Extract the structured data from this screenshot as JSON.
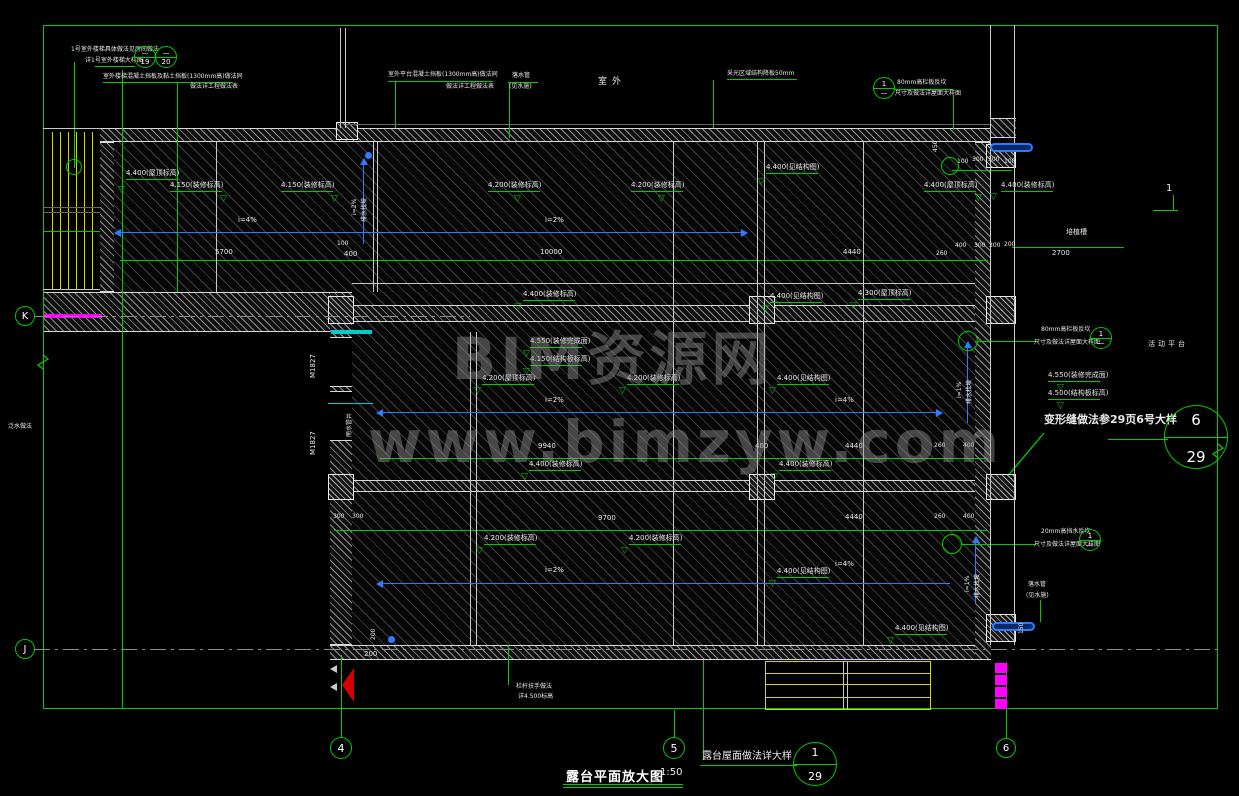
{
  "meta": {
    "drawing_type": "CAD terrace enlarged plan",
    "colors": {
      "line_green": "#00cc00",
      "wall_white": "#d8d8d8",
      "slope_blue": "#2f7bff",
      "stair_yellow": "#d6d600",
      "accent_magenta": "#ff00ff",
      "door_cyan": "#00cccc",
      "flag_red": "#d40000"
    }
  },
  "titles": {
    "main": "露台平面放大图",
    "scale": "1:50",
    "roof_note": "露台屋面做法详大样"
  },
  "watermark": {
    "line1": "BIM资源网",
    "line2": "www.bimzyw.com"
  },
  "texts": [
    {
      "t": "1号室外楼梯具体做法见房间做法",
      "x": 71,
      "y": 47,
      "fs": 6
    },
    {
      "t": "详1号室外楼梯大样图",
      "x": 85,
      "y": 58,
      "fs": 6
    },
    {
      "t": "室外楼梯混凝土挡板及黏土挡板(1300mm高)做法同",
      "x": 103,
      "y": 74,
      "fs": 6
    },
    {
      "t": "做法详工程做法表",
      "x": 190,
      "y": 84,
      "fs": 6
    },
    {
      "t": "室外平台混凝土挡板(1300mm高)做法同",
      "x": 388,
      "y": 72,
      "fs": 6
    },
    {
      "t": "做法详工程做法表",
      "x": 446,
      "y": 84,
      "fs": 6
    },
    {
      "t": "落水管",
      "x": 512,
      "y": 73,
      "fs": 6
    },
    {
      "t": "(见水施)",
      "x": 509,
      "y": 84,
      "fs": 6
    },
    {
      "t": "室外",
      "x": 598,
      "y": 78,
      "fs": 9,
      "ls": 5
    },
    {
      "t": "采光区域结构降板50mm",
      "x": 727,
      "y": 71,
      "fs": 6
    },
    {
      "t": "80mm高栏板反坎",
      "x": 897,
      "y": 80,
      "fs": 6
    },
    {
      "t": "尺寸及做法详屋面大样图",
      "x": 895,
      "y": 91,
      "fs": 6
    },
    {
      "t": "培植槽",
      "x": 1066,
      "y": 229,
      "fs": 7
    },
    {
      "t": "2700",
      "x": 1052,
      "y": 250,
      "fs": 7
    },
    {
      "t": "5700",
      "x": 215,
      "y": 249,
      "fs": 7
    },
    {
      "t": "100",
      "x": 337,
      "y": 241,
      "fs": 6
    },
    {
      "t": "400",
      "x": 344,
      "y": 251,
      "fs": 7
    },
    {
      "t": "10000",
      "x": 540,
      "y": 249,
      "fs": 7
    },
    {
      "t": "4440",
      "x": 843,
      "y": 249,
      "fs": 7
    },
    {
      "t": "260",
      "x": 936,
      "y": 251,
      "fs": 6
    },
    {
      "t": "400",
      "x": 955,
      "y": 243,
      "fs": 6
    },
    {
      "t": "300",
      "x": 974,
      "y": 243,
      "fs": 6
    },
    {
      "t": "300",
      "x": 989,
      "y": 243,
      "fs": 6
    },
    {
      "t": "200",
      "x": 1004,
      "y": 242,
      "fs": 6
    },
    {
      "t": "100",
      "x": 957,
      "y": 159,
      "fs": 6
    },
    {
      "t": "300",
      "x": 972,
      "y": 157,
      "fs": 6
    },
    {
      "t": "300",
      "x": 988,
      "y": 157,
      "fs": 6
    },
    {
      "t": "100",
      "x": 1004,
      "y": 159,
      "fs": 6
    },
    {
      "t": "i=4%",
      "x": 238,
      "y": 217,
      "fs": 7
    },
    {
      "t": "i=2%",
      "x": 545,
      "y": 217,
      "fs": 7
    },
    {
      "t": "i=2%",
      "x": 545,
      "y": 397,
      "fs": 7
    },
    {
      "t": "i=4%",
      "x": 835,
      "y": 397,
      "fs": 7
    },
    {
      "t": "i=2%",
      "x": 545,
      "y": 567,
      "fs": 7
    },
    {
      "t": "i=4%",
      "x": 835,
      "y": 561,
      "fs": 7
    },
    {
      "t": "9940",
      "x": 538,
      "y": 443,
      "fs": 7
    },
    {
      "t": "400",
      "x": 755,
      "y": 443,
      "fs": 7
    },
    {
      "t": "4440",
      "x": 845,
      "y": 443,
      "fs": 7
    },
    {
      "t": "260",
      "x": 934,
      "y": 443,
      "fs": 6
    },
    {
      "t": "400",
      "x": 963,
      "y": 443,
      "fs": 6
    },
    {
      "t": "300",
      "x": 333,
      "y": 514,
      "fs": 6
    },
    {
      "t": "300",
      "x": 352,
      "y": 514,
      "fs": 6
    },
    {
      "t": "9700",
      "x": 598,
      "y": 515,
      "fs": 7
    },
    {
      "t": "4440",
      "x": 845,
      "y": 514,
      "fs": 7
    },
    {
      "t": "260",
      "x": 934,
      "y": 514,
      "fs": 6
    },
    {
      "t": "400",
      "x": 963,
      "y": 514,
      "fs": 6
    },
    {
      "t": "200",
      "x": 364,
      "y": 651,
      "fs": 7
    },
    {
      "t": "栏杆扶手做法",
      "x": 516,
      "y": 684,
      "fs": 6
    },
    {
      "t": "详4.500标高",
      "x": 518,
      "y": 694,
      "fs": 6
    },
    {
      "t": "80mm高栏板反坎",
      "x": 1041,
      "y": 327,
      "fs": 6
    },
    {
      "t": "尺寸及做法详屋面大样图",
      "x": 1034,
      "y": 340,
      "fs": 6
    },
    {
      "t": "活动平台",
      "x": 1148,
      "y": 341,
      "fs": 7,
      "ls": 3
    },
    {
      "t": "变形缝做法参29页6号大样",
      "x": 1044,
      "y": 414,
      "fs": 11,
      "b": 1
    },
    {
      "t": "20mm高挡水反坎",
      "x": 1041,
      "y": 529,
      "fs": 6
    },
    {
      "t": "尺寸及做法详屋面大样图",
      "x": 1034,
      "y": 542,
      "fs": 6
    },
    {
      "t": "落水管",
      "x": 1028,
      "y": 582,
      "fs": 6
    },
    {
      "t": "(见水施)",
      "x": 1026,
      "y": 593,
      "fs": 6
    },
    {
      "t": "1",
      "x": 1166,
      "y": 184,
      "fs": 10
    },
    {
      "t": "泛水做法",
      "x": 8,
      "y": 424,
      "fs": 6
    },
    {
      "t": "M1827",
      "x": 310,
      "y": 378,
      "fs": 7,
      "r": 1
    },
    {
      "t": "M1827",
      "x": 310,
      "y": 455,
      "fs": 7,
      "r": 1
    },
    {
      "t": "雨水管井",
      "x": 347,
      "y": 437,
      "fs": 6,
      "r": 1
    },
    {
      "t": "i=2%",
      "x": 352,
      "y": 215,
      "fs": 6,
      "r": 1
    },
    {
      "t": "排水找坡",
      "x": 362,
      "y": 222,
      "fs": 6,
      "r": 1
    },
    {
      "t": "i=1%",
      "x": 957,
      "y": 398,
      "fs": 6,
      "r": 1
    },
    {
      "t": "排水找坡",
      "x": 967,
      "y": 404,
      "fs": 6,
      "r": 1
    },
    {
      "t": "i=1%",
      "x": 965,
      "y": 592,
      "fs": 6,
      "r": 1
    },
    {
      "t": "排水找坡",
      "x": 975,
      "y": 598,
      "fs": 6,
      "r": 1
    },
    {
      "t": "450",
      "x": 933,
      "y": 152,
      "fs": 6,
      "r": 1
    },
    {
      "t": "200",
      "x": 371,
      "y": 640,
      "fs": 6,
      "r": 1
    },
    {
      "t": "150",
      "x": 1019,
      "y": 634,
      "fs": 6,
      "r": 1
    }
  ],
  "elevations": [
    {
      "t": "4.400(屋顶标高)",
      "x": 126,
      "y": 170,
      "tx": 118,
      "ty": 186
    },
    {
      "t": "4.150(装修标高)",
      "x": 170,
      "y": 182,
      "tx": 220,
      "ty": 195
    },
    {
      "t": "4.150(装修标高)",
      "x": 281,
      "y": 182,
      "tx": 331,
      "ty": 195
    },
    {
      "t": "4.200(装修标高)",
      "x": 488,
      "y": 182,
      "tx": 514,
      "ty": 195
    },
    {
      "t": "4.200(装修标高)",
      "x": 631,
      "y": 182,
      "tx": 658,
      "ty": 195
    },
    {
      "t": "4.400(见结构图)",
      "x": 766,
      "y": 164,
      "tx": 758,
      "ty": 178
    },
    {
      "t": "4.400(屋顶标高)",
      "x": 924,
      "y": 182,
      "tx": 975,
      "ty": 194
    },
    {
      "t": "4.400(装修标高)",
      "x": 1001,
      "y": 182,
      "tx": 990,
      "ty": 193
    },
    {
      "t": "4.400(装修标高)",
      "x": 523,
      "y": 291,
      "tx": 515,
      "ty": 303
    },
    {
      "t": "4.400(见结构图)",
      "x": 770,
      "y": 293,
      "tx": 762,
      "ty": 305
    },
    {
      "t": "4.300(屋顶标高)",
      "x": 858,
      "y": 290,
      "tx": 850,
      "ty": 302
    },
    {
      "t": "4.550(装修完成面)",
      "x": 530,
      "y": 338,
      "tx": 523,
      "ty": 350
    },
    {
      "t": "4.150(结构板标高)",
      "x": 530,
      "y": 356,
      "tx": 523,
      "ty": 368
    },
    {
      "t": "4.200(屋顶标高)",
      "x": 482,
      "y": 375,
      "tx": 474,
      "ty": 387
    },
    {
      "t": "4.200(装修标高)",
      "x": 627,
      "y": 375,
      "tx": 619,
      "ty": 387
    },
    {
      "t": "4.400(见结构图)",
      "x": 777,
      "y": 375,
      "tx": 769,
      "ty": 387
    },
    {
      "t": "4.400(装修标高)",
      "x": 529,
      "y": 461,
      "tx": 521,
      "ty": 473
    },
    {
      "t": "4.400(装修标高)",
      "x": 779,
      "y": 461,
      "tx": 771,
      "ty": 473
    },
    {
      "t": "4.200(装修标高)",
      "x": 484,
      "y": 535,
      "tx": 476,
      "ty": 547
    },
    {
      "t": "4.200(装修标高)",
      "x": 629,
      "y": 535,
      "tx": 621,
      "ty": 547
    },
    {
      "t": "4.400(见结构图)",
      "x": 777,
      "y": 568,
      "tx": 769,
      "ty": 580
    },
    {
      "t": "4.400(见结构图)",
      "x": 895,
      "y": 625,
      "tx": 887,
      "ty": 637
    },
    {
      "t": "4.550(装修完成面)",
      "x": 1048,
      "y": 372,
      "tx": 1057,
      "ty": 384
    },
    {
      "t": "4.500(结构板标高)",
      "x": 1048,
      "y": 390,
      "tx": 1057,
      "ty": 402
    }
  ],
  "detail_bubbles": [
    {
      "x": 145,
      "y": 57,
      "r": 11,
      "top": "—",
      "bot": "19"
    },
    {
      "x": 166,
      "y": 57,
      "r": 11,
      "top": "—",
      "bot": "20"
    },
    {
      "x": 884,
      "y": 88,
      "r": 11,
      "top": "1",
      "bot": "—"
    },
    {
      "x": 1101,
      "y": 338,
      "r": 11,
      "top": "1",
      "bot": "—"
    },
    {
      "x": 1090,
      "y": 540,
      "r": 11,
      "top": "1",
      "bot": "—"
    },
    {
      "x": 1196,
      "y": 437,
      "r": 32,
      "top": "6",
      "bot": "29"
    },
    {
      "x": 815,
      "y": 764,
      "r": 22,
      "top": "1",
      "bot": "29"
    }
  ],
  "grid_bubbles": [
    {
      "t": "K",
      "x": 25,
      "y": 316,
      "r": 10
    },
    {
      "t": "J",
      "x": 25,
      "y": 649,
      "r": 10
    },
    {
      "t": "4",
      "x": 341,
      "y": 748,
      "r": 11
    },
    {
      "t": "5",
      "x": 674,
      "y": 748,
      "r": 11
    },
    {
      "t": "6",
      "x": 1006,
      "y": 748,
      "r": 10
    }
  ],
  "head_circles": [
    {
      "x": 74,
      "y": 167,
      "r": 8
    },
    {
      "x": 950,
      "y": 166,
      "r": 9
    },
    {
      "x": 968,
      "y": 341,
      "r": 10
    },
    {
      "x": 952,
      "y": 544,
      "r": 10
    }
  ],
  "hatches": [
    {
      "x": 100,
      "y": 142,
      "w": 875,
      "h": 150
    },
    {
      "x": 352,
      "y": 292,
      "w": 623,
      "h": 353
    }
  ],
  "walls": [
    {
      "x": 100,
      "y": 128,
      "w": 890,
      "h": 14
    },
    {
      "x": 100,
      "y": 142,
      "w": 14,
      "h": 150
    },
    {
      "x": 43,
      "y": 292,
      "w": 309,
      "h": 40
    },
    {
      "x": 352,
      "y": 305,
      "w": 623,
      "h": 17
    },
    {
      "x": 330,
      "y": 292,
      "w": 22,
      "h": 46
    },
    {
      "x": 330,
      "y": 386,
      "w": 22,
      "h": 6
    },
    {
      "x": 330,
      "y": 440,
      "w": 22,
      "h": 205
    },
    {
      "x": 330,
      "y": 645,
      "w": 660,
      "h": 15
    },
    {
      "x": 975,
      "y": 142,
      "w": 16,
      "h": 518
    },
    {
      "x": 352,
      "y": 480,
      "w": 623,
      "h": 12
    },
    {
      "x": 990,
      "y": 118,
      "w": 26,
      "h": 20
    }
  ],
  "cols": [
    {
      "x": 328,
      "y": 296,
      "w": 26,
      "h": 28
    },
    {
      "x": 749,
      "y": 296,
      "w": 26,
      "h": 28
    },
    {
      "x": 749,
      "y": 474,
      "w": 26,
      "h": 26
    },
    {
      "x": 328,
      "y": 474,
      "w": 26,
      "h": 26
    },
    {
      "x": 986,
      "y": 144,
      "w": 30,
      "h": 24
    },
    {
      "x": 986,
      "y": 296,
      "w": 30,
      "h": 28
    },
    {
      "x": 986,
      "y": 474,
      "w": 30,
      "h": 26
    },
    {
      "x": 986,
      "y": 614,
      "w": 30,
      "h": 28
    },
    {
      "x": 336,
      "y": 122,
      "w": 22,
      "h": 18
    }
  ],
  "lines": [
    [
      "g",
      43,
      25,
      1175,
      1
    ],
    [
      "g",
      43,
      25,
      1,
      684
    ],
    [
      "g",
      1217,
      25,
      1,
      684
    ],
    [
      "g",
      43,
      708,
      1175,
      1
    ],
    [
      "g",
      74,
      62,
      1,
      106
    ],
    [
      "g",
      122,
      70,
      1,
      638
    ],
    [
      "g",
      177,
      83,
      1,
      209
    ],
    [
      "g",
      395,
      81,
      1,
      47
    ],
    [
      "g",
      509,
      82,
      1,
      56
    ],
    [
      "g",
      713,
      80,
      1,
      48
    ],
    [
      "g",
      953,
      95,
      1,
      35
    ],
    [
      "g",
      341,
      655,
      1,
      83
    ],
    [
      "g",
      674,
      710,
      1,
      28
    ],
    [
      "g",
      1006,
      662,
      1,
      77
    ],
    [
      "g",
      703,
      660,
      1,
      100
    ],
    [
      "g",
      508,
      645,
      1,
      40
    ],
    [
      "g",
      1040,
      600,
      1,
      22
    ],
    [
      "g",
      95,
      66,
      40,
      1
    ],
    [
      "g",
      103,
      82,
      130,
      1
    ],
    [
      "g",
      388,
      81,
      105,
      1
    ],
    [
      "g",
      508,
      82,
      30,
      1
    ],
    [
      "g",
      727,
      79,
      70,
      1
    ],
    [
      "g",
      895,
      89,
      58,
      1
    ],
    [
      "g",
      978,
      341,
      58,
      1
    ],
    [
      "g",
      962,
      544,
      74,
      1
    ],
    [
      "g",
      1108,
      439,
      60,
      1
    ],
    [
      "g",
      1173,
      195,
      1,
      16
    ],
    [
      "g",
      1153,
      210,
      25,
      1
    ],
    [
      "g",
      563,
      784,
      120,
      1
    ],
    [
      "g",
      563,
      787,
      120,
      1
    ],
    [
      "g",
      700,
      765,
      97,
      1
    ],
    [
      "g",
      120,
      260,
      868,
      1
    ],
    [
      "g",
      1012,
      247,
      112,
      1
    ],
    [
      "g",
      380,
      458,
      608,
      1
    ],
    [
      "g",
      334,
      530,
      654,
      1
    ],
    [
      "g",
      43,
      231,
      57,
      1
    ],
    [
      "g",
      952,
      170,
      60,
      1
    ],
    [
      "w",
      990,
      25,
      1,
      620
    ],
    [
      "w",
      1014,
      25,
      1,
      620
    ],
    [
      "gr",
      345,
      124,
      645,
      1
    ],
    [
      "w",
      352,
      283,
      623,
      1
    ],
    [
      "w",
      216,
      142,
      1,
      150
    ],
    [
      "w",
      373,
      142,
      1,
      150
    ],
    [
      "w",
      377,
      142,
      1,
      150
    ],
    [
      "w",
      673,
      142,
      1,
      503
    ],
    [
      "w",
      757,
      142,
      1,
      503
    ],
    [
      "w",
      764,
      142,
      1,
      503
    ],
    [
      "w",
      863,
      142,
      1,
      503
    ],
    [
      "w",
      470,
      332,
      1,
      313
    ],
    [
      "w",
      476,
      332,
      1,
      313
    ],
    [
      "w",
      43,
      128,
      57,
      1
    ],
    [
      "w",
      43,
      289,
      57,
      1
    ],
    [
      "gr",
      43,
      207,
      57,
      1
    ],
    [
      "gr",
      43,
      212,
      57,
      1
    ],
    [
      "w",
      340,
      28,
      1,
      100
    ],
    [
      "w",
      345,
      28,
      1,
      100
    ],
    [
      "y",
      765,
      661,
      166,
      1
    ],
    [
      "y",
      765,
      673,
      166,
      1
    ],
    [
      "y",
      765,
      684,
      166,
      1
    ],
    [
      "y",
      765,
      697,
      166,
      1
    ],
    [
      "y",
      765,
      709,
      166,
      1
    ],
    [
      "y",
      765,
      661,
      1,
      49
    ],
    [
      "y",
      930,
      661,
      1,
      49
    ],
    [
      "w",
      843,
      661,
      1,
      49
    ],
    [
      "w",
      847,
      661,
      1,
      49
    ],
    [
      "b",
      120,
      232,
      625,
      1
    ],
    [
      "b",
      380,
      412,
      560,
      1
    ],
    [
      "b",
      380,
      583,
      570,
      1
    ],
    [
      "b",
      363,
      162,
      1,
      82
    ],
    [
      "b",
      967,
      345,
      1,
      78
    ],
    [
      "b",
      975,
      540,
      1,
      64
    ],
    [
      "m",
      44,
      314,
      58,
      4
    ],
    [
      "c",
      331,
      330,
      41,
      4
    ],
    [
      "c",
      328,
      403,
      45,
      1
    ]
  ],
  "dashes": [
    {
      "x": 34,
      "y": 316,
      "w": 436
    },
    {
      "x": 34,
      "y": 649,
      "w": 1183
    }
  ],
  "tris": [
    {
      "x": 114,
      "y": 229,
      "d": "l",
      "c": "b"
    },
    {
      "x": 741,
      "y": 229,
      "d": "r",
      "c": "b"
    },
    {
      "x": 376,
      "y": 409,
      "d": "l",
      "c": "b"
    },
    {
      "x": 936,
      "y": 409,
      "d": "r",
      "c": "b"
    },
    {
      "x": 376,
      "y": 580,
      "d": "l",
      "c": "b"
    },
    {
      "x": 360,
      "y": 158,
      "d": "u",
      "c": "b"
    },
    {
      "x": 964,
      "y": 341,
      "d": "u",
      "c": "b"
    },
    {
      "x": 972,
      "y": 536,
      "d": "u",
      "c": "b"
    },
    {
      "x": 330,
      "y": 665,
      "d": "l",
      "c": "w"
    },
    {
      "x": 330,
      "y": 683,
      "d": "l",
      "c": "w"
    }
  ],
  "capsules": [
    {
      "x": 990,
      "y": 143,
      "w": 43,
      "h": 9
    },
    {
      "x": 992,
      "y": 622,
      "w": 43,
      "h": 9
    }
  ],
  "dots": [
    {
      "x": 365,
      "y": 152
    },
    {
      "x": 388,
      "y": 636
    }
  ],
  "mblocks": [
    {
      "x": 995,
      "y": 663
    },
    {
      "x": 995,
      "y": 675
    },
    {
      "x": 995,
      "y": 687
    },
    {
      "x": 995,
      "y": 699
    }
  ],
  "ystripes": [
    {
      "x": 45,
      "y": 132,
      "w": 54,
      "h": 155
    },
    {
      "x": 45,
      "y": 276,
      "w": 54,
      "h": 13
    }
  ],
  "paths": [
    {
      "d": "M398,338 A46,46 0 0 1 352,384",
      "c": "#00cccc"
    },
    {
      "d": "M398,442 A46,46 0 0 0 352,396",
      "c": "#00cccc"
    },
    {
      "d": "M990,497 L1044,433",
      "c": "#00cc00"
    },
    {
      "d": "M43,355 L48,359 L38,365 L43,369",
      "c": "#00cc00"
    },
    {
      "d": "M1218,444 L1223,448 L1213,454 L1218,458",
      "c": "#00cc00"
    }
  ]
}
